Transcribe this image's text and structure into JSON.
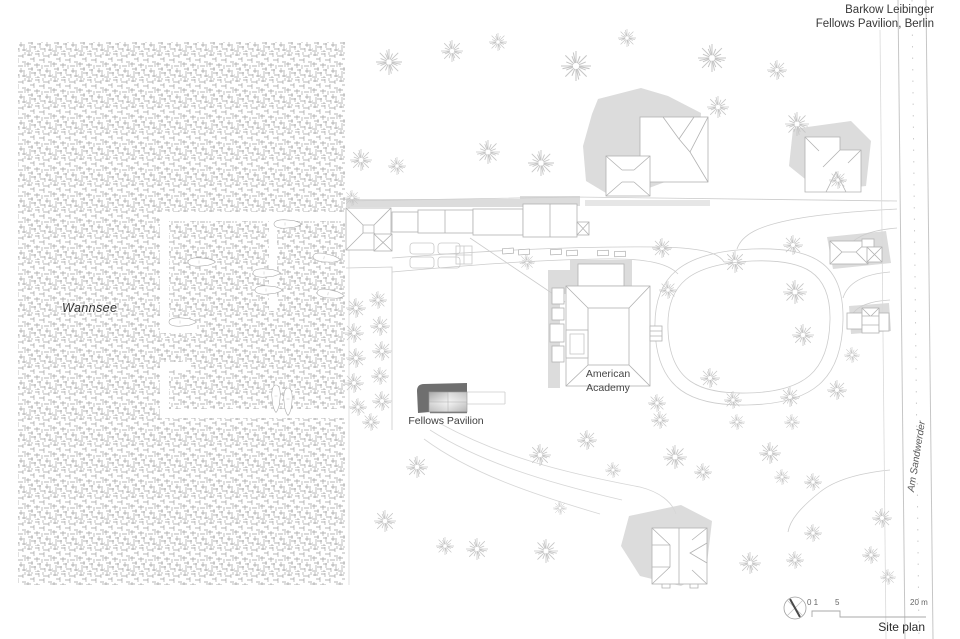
{
  "header": {
    "studio": "Barkow Leibinger",
    "project": "Fellows Pavilion, Berlin"
  },
  "plan_labels": {
    "water": "Wannsee",
    "academy_line1": "American",
    "academy_line2": "Academy",
    "pavilion": "Fellows Pavilion",
    "street": "Am Sandwerder"
  },
  "scale_bar": {
    "zero_one": "0 1",
    "five": "5",
    "twenty": "20 m"
  },
  "caption": "Site plan",
  "colors": {
    "background": "#ffffff",
    "line_work": "#b2b2b2",
    "path_line": "#cccccc",
    "shadow_fill": "#dcdcdc",
    "water_hatch": "#8c8c8c",
    "tree_stroke": "#c6c6c6",
    "pavilion_dark": "#6f6f6f",
    "text": "#3a3a3a"
  },
  "trees": [
    [
      389,
      62,
      1.3
    ],
    [
      452,
      51,
      1.1
    ],
    [
      498,
      42,
      0.9
    ],
    [
      576,
      66,
      1.5
    ],
    [
      627,
      38,
      0.9
    ],
    [
      712,
      58,
      1.4
    ],
    [
      777,
      70,
      1.0
    ],
    [
      718,
      107,
      1.1
    ],
    [
      797,
      124,
      1.2
    ],
    [
      361,
      160,
      1.1
    ],
    [
      397,
      166,
      0.9
    ],
    [
      488,
      152,
      1.2
    ],
    [
      541,
      163,
      1.3
    ],
    [
      352,
      198,
      0.8
    ],
    [
      838,
      180,
      0.9
    ],
    [
      356,
      308,
      1.0
    ],
    [
      354,
      333,
      1.0
    ],
    [
      356,
      358,
      1.0
    ],
    [
      354,
      383,
      1.0
    ],
    [
      358,
      407,
      0.9
    ],
    [
      378,
      300,
      0.9
    ],
    [
      380,
      326,
      1.0
    ],
    [
      382,
      351,
      1.0
    ],
    [
      380,
      376,
      0.9
    ],
    [
      382,
      401,
      1.0
    ],
    [
      371,
      422,
      0.9
    ],
    [
      527,
      262,
      0.8
    ],
    [
      662,
      248,
      1.0
    ],
    [
      735,
      262,
      1.1
    ],
    [
      793,
      245,
      1.0
    ],
    [
      795,
      292,
      1.2
    ],
    [
      668,
      290,
      0.9
    ],
    [
      803,
      335,
      1.1
    ],
    [
      710,
      378,
      1.0
    ],
    [
      733,
      400,
      0.9
    ],
    [
      790,
      397,
      1.0
    ],
    [
      837,
      390,
      1.0
    ],
    [
      657,
      403,
      0.9
    ],
    [
      852,
      355,
      0.8
    ],
    [
      417,
      467,
      1.1
    ],
    [
      385,
      521,
      1.1
    ],
    [
      445,
      546,
      0.9
    ],
    [
      477,
      549,
      1.1
    ],
    [
      546,
      551,
      1.2
    ],
    [
      540,
      455,
      1.1
    ],
    [
      587,
      440,
      1.0
    ],
    [
      613,
      470,
      0.8
    ],
    [
      675,
      457,
      1.2
    ],
    [
      703,
      472,
      0.9
    ],
    [
      770,
      453,
      1.1
    ],
    [
      782,
      477,
      0.8
    ],
    [
      813,
      482,
      0.9
    ],
    [
      882,
      518,
      1.0
    ],
    [
      813,
      533,
      0.9
    ],
    [
      750,
      563,
      1.1
    ],
    [
      795,
      560,
      0.9
    ],
    [
      871,
      555,
      0.9
    ],
    [
      888,
      577,
      0.8
    ],
    [
      660,
      420,
      0.9
    ],
    [
      737,
      422,
      0.8
    ],
    [
      792,
      422,
      0.8
    ],
    [
      560,
      508,
      0.7
    ]
  ],
  "boats": [
    [
      201,
      262,
      0
    ],
    [
      182,
      322,
      0
    ],
    [
      266,
      273,
      0
    ],
    [
      268,
      290,
      0
    ],
    [
      287,
      224,
      0
    ],
    [
      326,
      258,
      8
    ],
    [
      330,
      294,
      8
    ],
    [
      276,
      398,
      90
    ],
    [
      288,
      401,
      90
    ]
  ],
  "cars": [
    [
      508,
      251,
      -4
    ],
    [
      524,
      252,
      -4
    ],
    [
      556,
      252,
      -3
    ],
    [
      572,
      253,
      -3
    ],
    [
      603,
      253,
      -2
    ],
    [
      620,
      254,
      -2
    ]
  ],
  "piers": [
    [
      160,
      212,
      186,
      9
    ],
    [
      160,
      221,
      9,
      112
    ],
    [
      160,
      324,
      37,
      9
    ],
    [
      269,
      221,
      8,
      90
    ],
    [
      160,
      409,
      186,
      9
    ],
    [
      160,
      362,
      9,
      47
    ],
    [
      160,
      362,
      31,
      8
    ]
  ]
}
